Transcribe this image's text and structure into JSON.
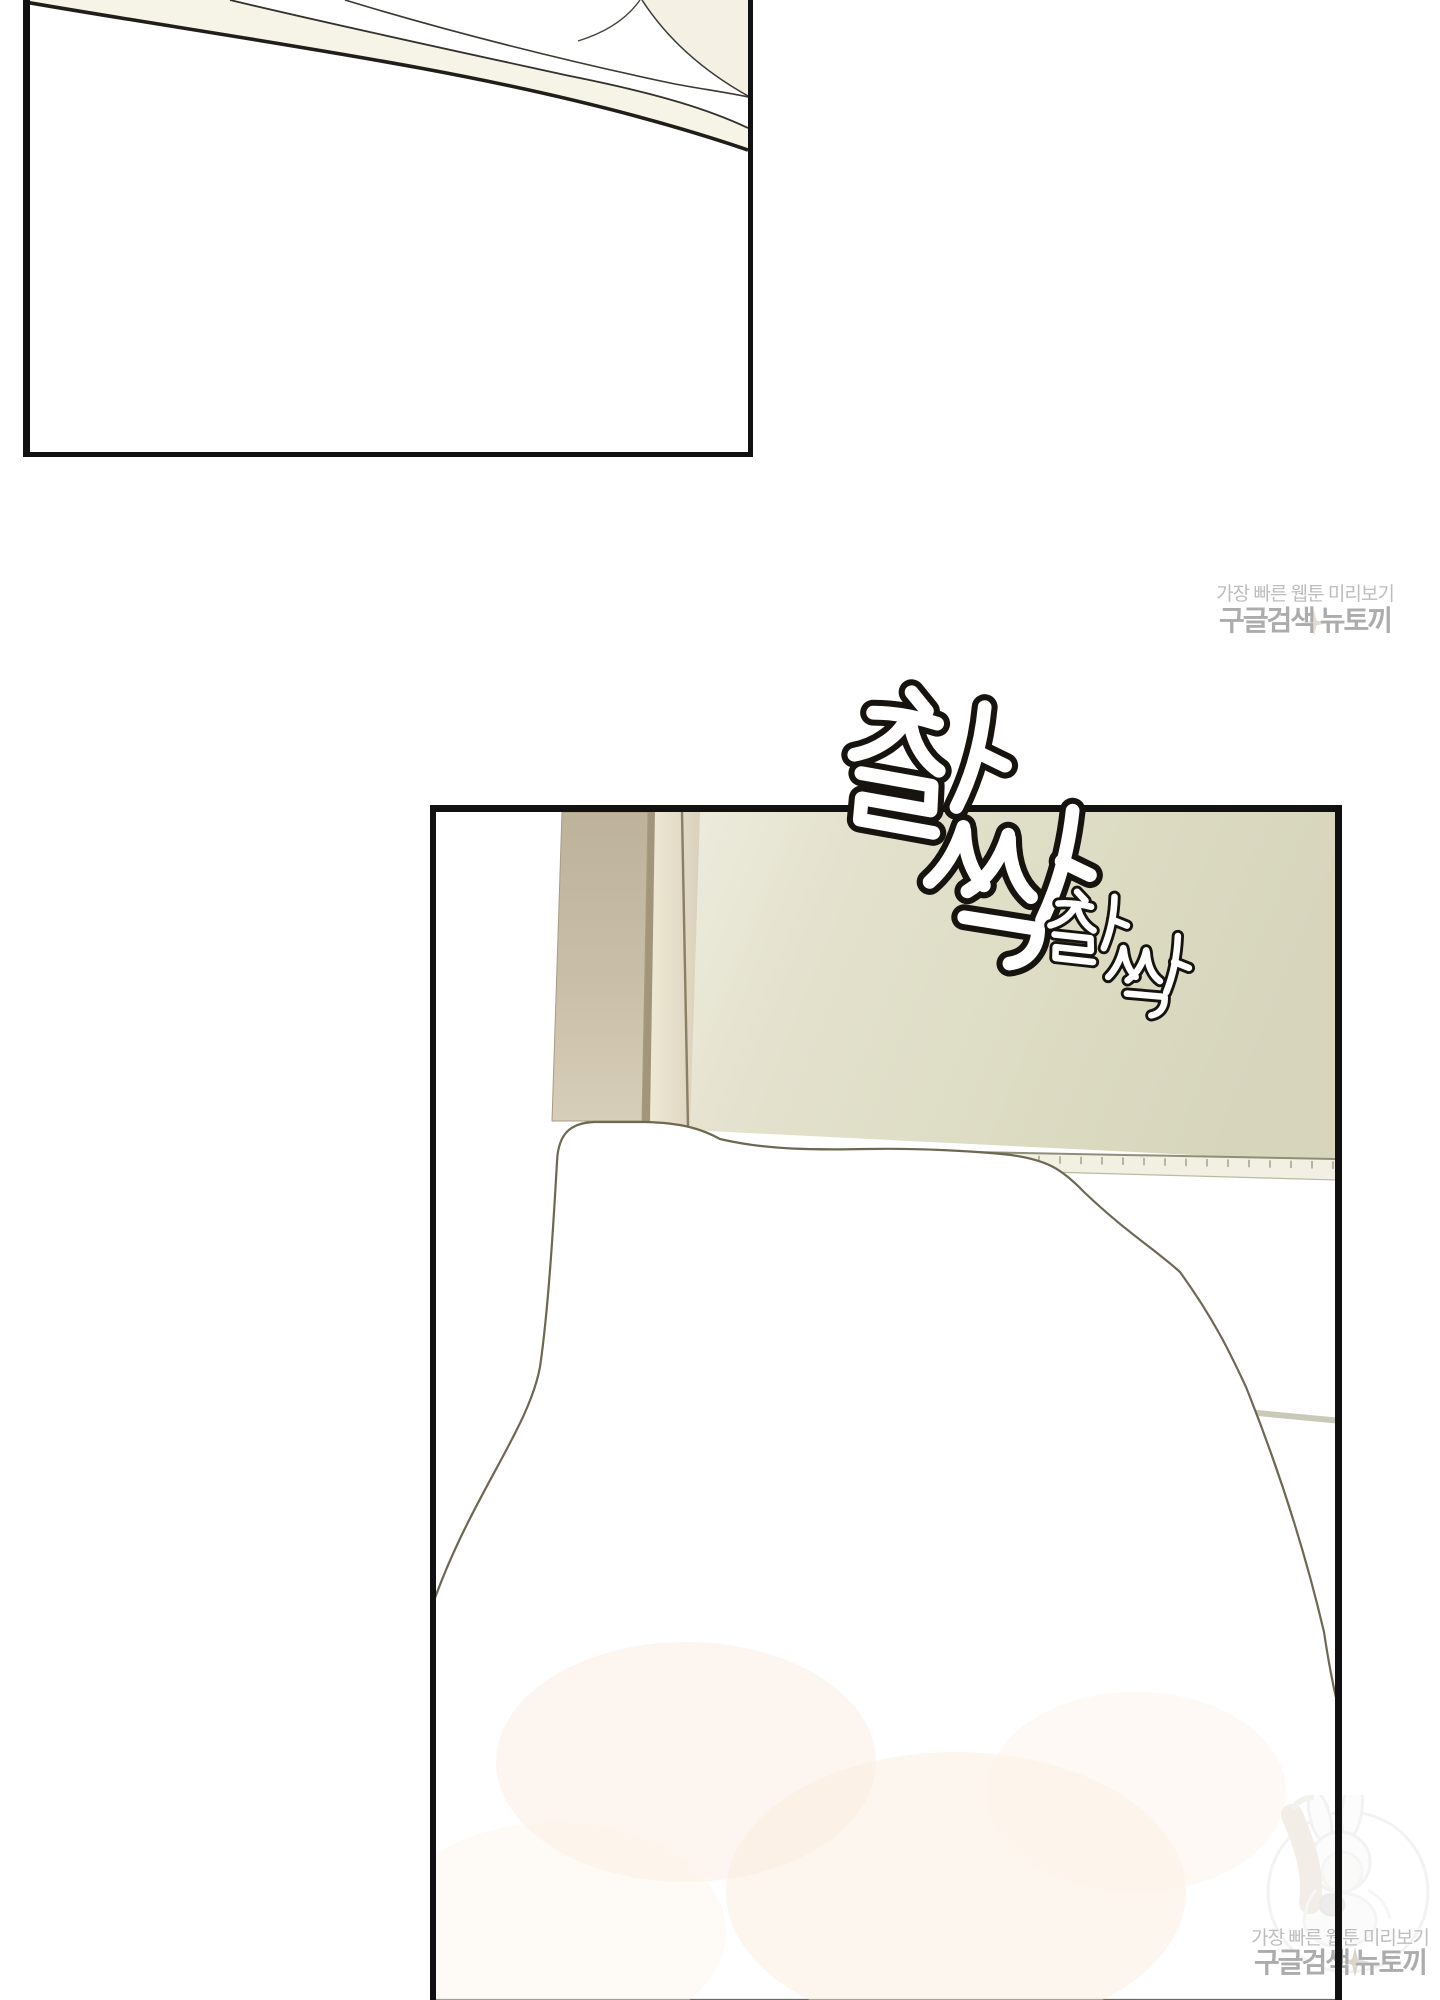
{
  "page": {
    "type": "webtoon-episode-image",
    "background": "#ffffff"
  },
  "sfx": {
    "large": {
      "text": "찰싹"
    },
    "small": {
      "text": "찰싹"
    }
  },
  "watermarks": {
    "top": {
      "line1": "가장 빠른 웹툰 미리보기",
      "line2": "구글검색 뉴토끼"
    },
    "bottom": {
      "line1": "가장 빠른 웹툰 미리보기",
      "line2": "구글검색 뉴토끼",
      "mascot_icon": "rabbit-girl-with-carrot-logo"
    }
  },
  "colors": {
    "panel_border": "#111111",
    "cream": "#f5f2e6",
    "wall": "#dfdec6",
    "door_tan_top": "#bdb29a",
    "door_tan_bottom": "#d7ceb9",
    "duvet_outline": "#6e6852",
    "watermark_text": "#b3b3b3"
  }
}
